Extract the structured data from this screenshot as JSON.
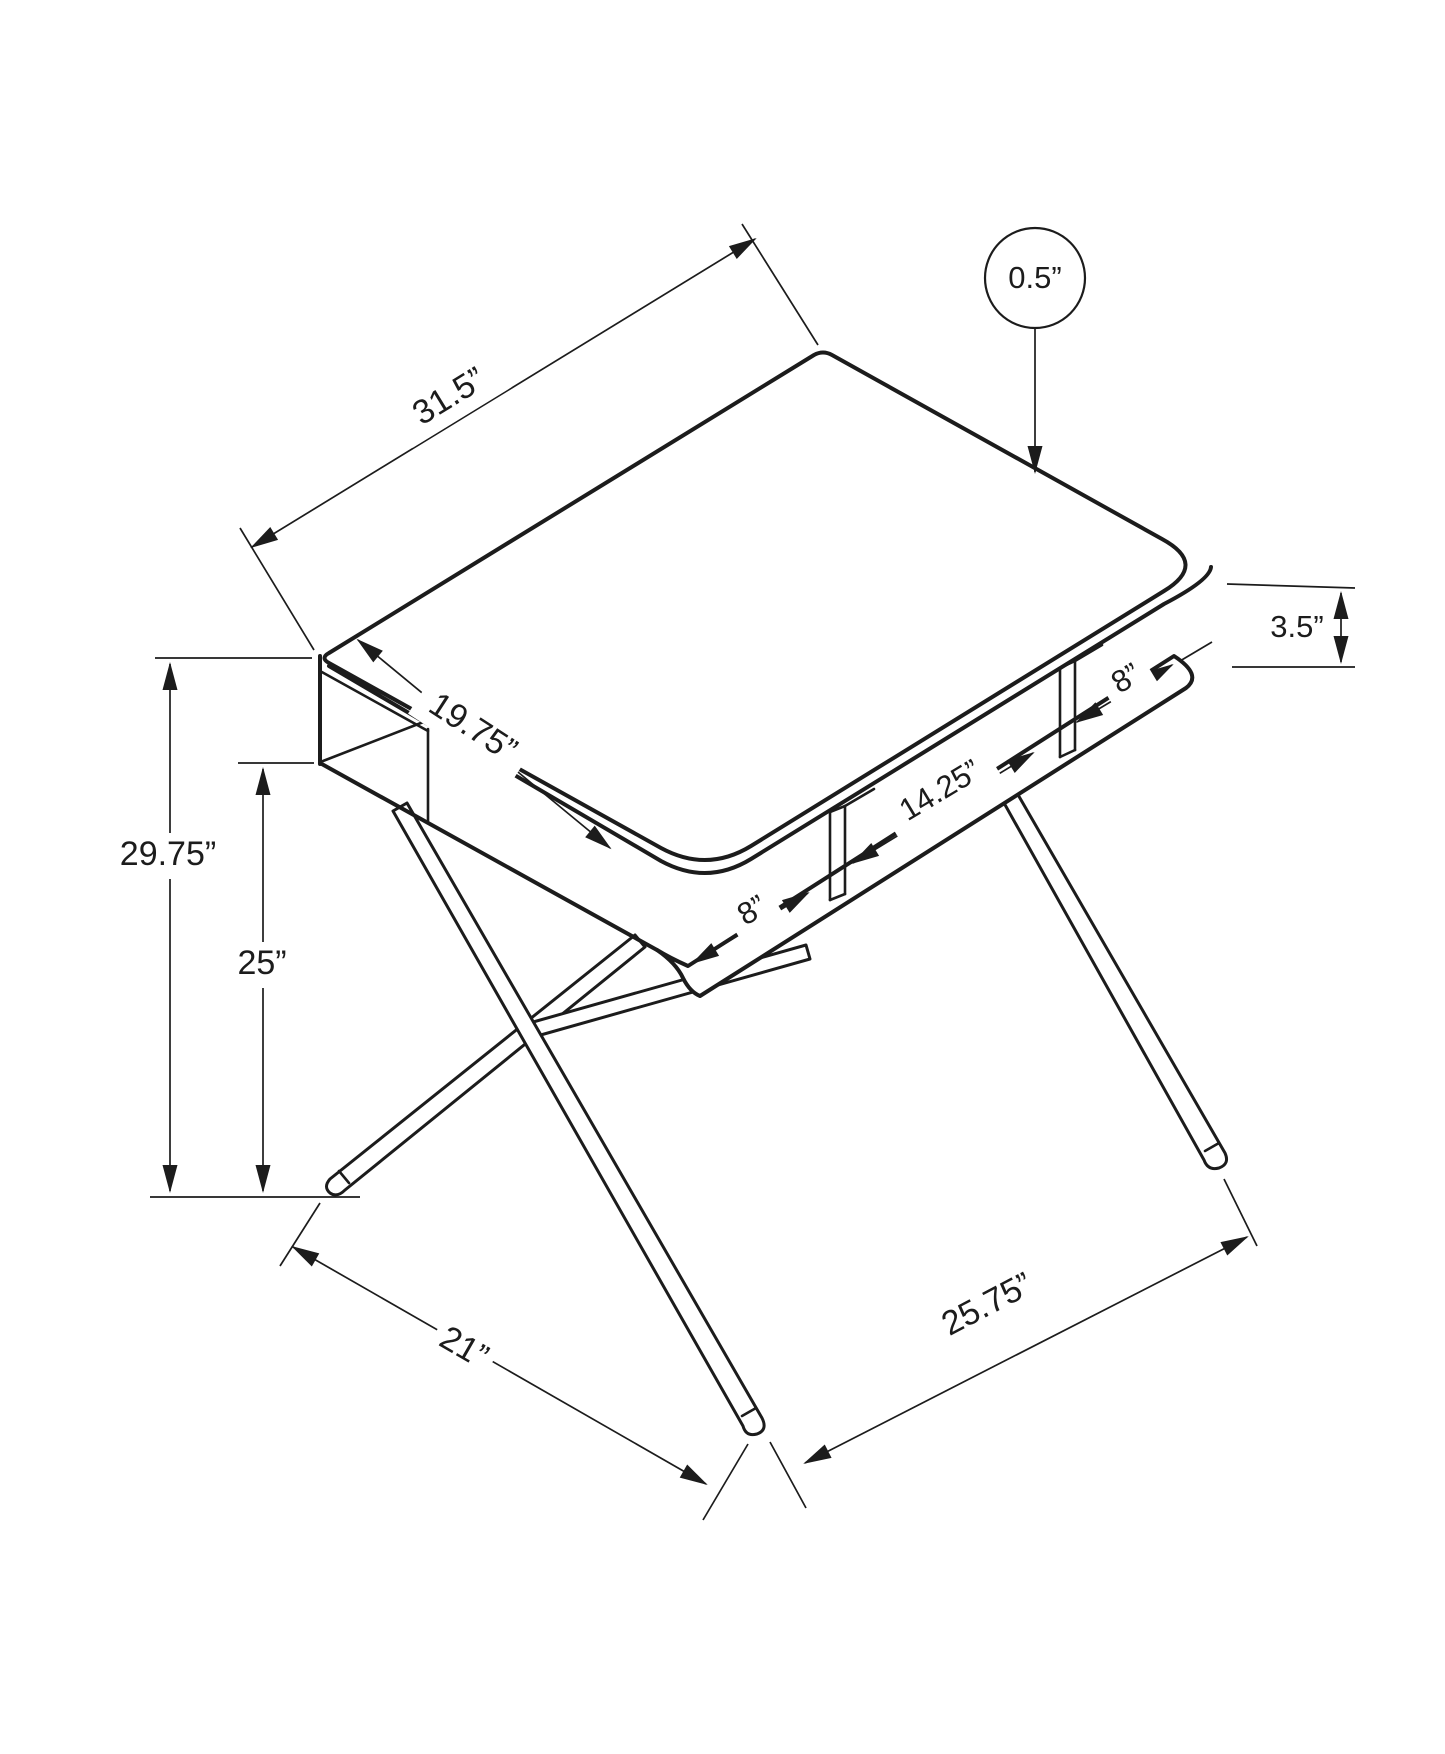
{
  "diagram": {
    "title": "Computer desk dimension drawing",
    "dimensions": {
      "top_length": "31.5”",
      "top_thickness": "0.5”",
      "clearance": "3.5”",
      "top_depth": "19.75”",
      "left_cubby": "8”",
      "middle_cubby": "14.25”",
      "right_cubby": "8”",
      "overall_height": "29.75”",
      "shelf_height": "25”",
      "base_depth": "21”",
      "base_width": "25.75”"
    }
  }
}
